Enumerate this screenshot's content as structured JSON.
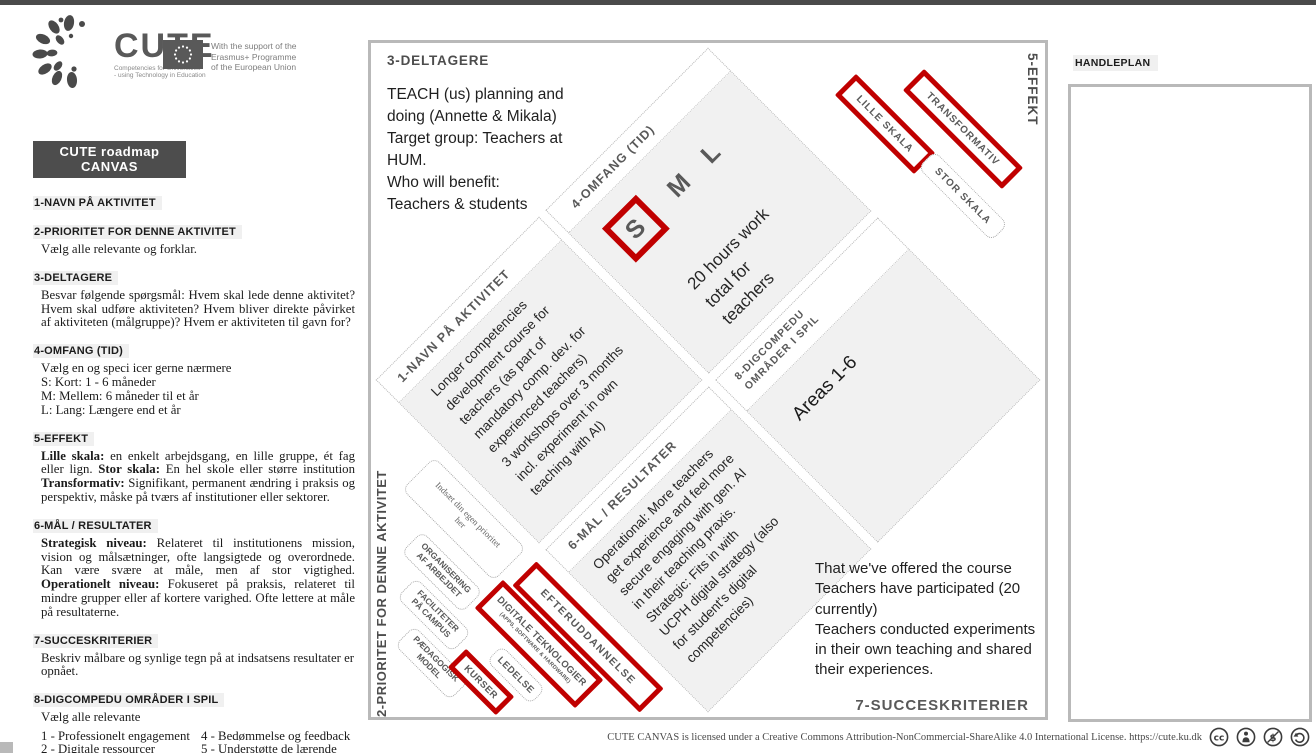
{
  "colors": {
    "red": "#c00000",
    "dark_gray": "#595959",
    "panel_gray": "#f1f1f1",
    "border_gray": "#b9b9b9"
  },
  "header": {
    "brand": "CUTE",
    "tagline": "Competencies for Universities\n- using Technology in Education",
    "eu_text": "With the support of the\nErasmus+ Programme\nof the European Union"
  },
  "sidebar": {
    "banner": "CUTE roadmap CANVAS",
    "s1": {
      "h": "1-NAVN PÅ AKTIVITET"
    },
    "s2": {
      "h": "2-PRIORITET FOR DENNE AKTIVITET",
      "body": "Vælg alle relevante og forklar."
    },
    "s3": {
      "h": "3-DELTAGERE",
      "body": "Besvar følgende spørgsmål: Hvem skal lede denne aktivitet? Hvem skal udføre aktiviteten? Hvem bliver direkte påvirket af aktiviteten (målgruppe)? Hvem er aktiviteten til gavn for?"
    },
    "s4": {
      "h": "4-OMFANG (TID)",
      "intro": "Vælg en og speci icer gerne nærmere",
      "items": "S: Kort: 1 - 6 måneder\nM: Mellem: 6 måneder til et år\nL: Lang: Længere end et år"
    },
    "s5": {
      "h": "5-EFFEKT",
      "b1": "Lille skala:",
      "t1": " en enkelt arbejdsgang, en lille gruppe, ét fag eller lign. ",
      "b2": "Stor skala:",
      "t2": " En hel skole eller større institution ",
      "b3": "Transformativ:",
      "t3": " Signifikant, permanent ændring i praksis og perspektiv, måske på tværs af institutioner eller sektorer."
    },
    "s6": {
      "h": "6-MÅL / RESULTATER",
      "b1": "Strategisk niveau:",
      "t1": " Relateret til institutionens mission, vision og målsætninger, ofte langsigtede og overordnede. Kan være svære at måle, men af stor vigtighed. ",
      "b2": "Operationelt niveau:",
      "t2": " Fokuseret på praksis, relateret til mindre grupper eller af kortere varighed. Ofte lettere at måle på resultaterne."
    },
    "s7": {
      "h": "7-SUCCESKRITERIER",
      "body": "Beskriv målbare og synlige tegn på at indsatsens resultater er opnået."
    },
    "s8": {
      "h": "8-DIGCOMPEDU OMRÅDER I SPIL",
      "intro": "Vælg alle relevante",
      "col1": "1 - Professionelt engagement\n2 - Digitale ressourcer\n3 - Undervisning og læring",
      "col2": "4 - Bedømmelse og feedback\n5 - Understøtte de lærende\n6 - Facilitering af studerendes\n      digitale kompetencer"
    }
  },
  "canvas": {
    "deltagere": {
      "h": "3-DELTAGERE",
      "text": "TEACH (us) planning and\ndoing (Annette & Mikala)\nTarget group: Teachers at\nHUM.\nWho will benefit:\nTeachers & students"
    },
    "effekt_label": "5-EFFEKT",
    "prioritet_label": "2-PRIORITET FOR DENNE AKTIVITET",
    "navn": {
      "h": "1-NAVN PÅ AKTIVITET",
      "text": "Longer competencies\ndevelopment course for\nteachers (as part of\nmandatory comp. dev. for\nexperienced teachers)\n3 workshops over 3 months\nincl. experiment in own\nteaching with AI)"
    },
    "omfang": {
      "h": "4-OMFANG (TID)",
      "s": "S",
      "m": "M",
      "l": "L",
      "text": "20 hours work\ntotal for\nteachers"
    },
    "digcompedu": {
      "h": "8-DIGCOMPEDU\nOMRÅDER I SPIL",
      "text": "Areas 1-6"
    },
    "maal": {
      "h": "6-MÅL / RESULTATER",
      "text": "Operational: More teachers\nget experience and feel more\nsecure engaging with gen. AI\nin their teaching praxis.\nStrategic: Fits in with\nUCPH digital strategy (also\nfor student's digital\ncompetencies)"
    },
    "effect_boxes": [
      {
        "label": "LILLE SKALA"
      },
      {
        "label": "TRANSFORMATIV"
      },
      {
        "label": "STOR SKALA"
      }
    ],
    "priority_boxes": [
      {
        "label": "Indsæt din egen prioritet\nher"
      },
      {
        "label": "ORGANISERING\nAF ARBEJDET"
      },
      {
        "label": "FACILITETER\nPÅ CAMPUS"
      },
      {
        "label": "PÆDAGOGISK\nMODEL"
      },
      {
        "label": "KURSER"
      },
      {
        "label": "LEDELSE"
      },
      {
        "label": "DIGITALE TEKNOLOGIER",
        "sub": "(APPS, SOFTWARE & HARDWARE)"
      },
      {
        "label": "EFTERUDDANNELSE"
      }
    ],
    "succes": {
      "h": "7-SUCCESKRITERIER",
      "text": "That we've offered the course\nTeachers have participated (20\ncurrently)\nTeachers conducted experiments\nin their own teaching and shared\ntheir experiences."
    }
  },
  "handleplan": {
    "label": "HANDLEPLAN"
  },
  "footer": {
    "license": "CUTE CANVAS is licensed under a Creative Commons Attribution-NonCommercial-ShareAlike 4.0 International License. https://cute.ku.dk",
    "cc_label": "cc"
  }
}
